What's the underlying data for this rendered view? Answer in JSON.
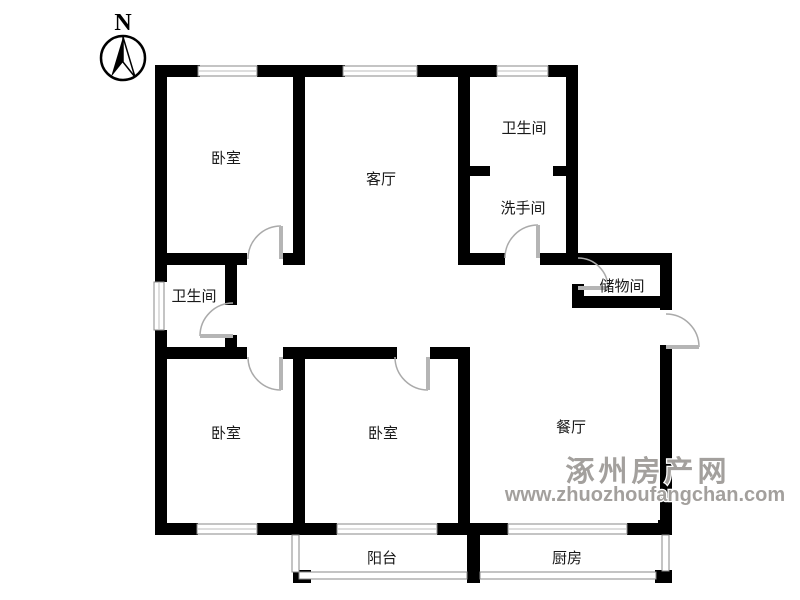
{
  "meta": {
    "background_color": "#ffffff",
    "wall_color": "#000000",
    "door_arc_color": "#aaaaaa",
    "window_frame_color": "#8a8a8a"
  },
  "compass": {
    "label": "N"
  },
  "rooms": [
    {
      "name": "bedroom-top-left",
      "label": "卧室"
    },
    {
      "name": "living-room",
      "label": "客厅"
    },
    {
      "name": "bathroom-top",
      "label": "卫生间"
    },
    {
      "name": "washroom",
      "label": "洗手间"
    },
    {
      "name": "storage-room",
      "label": "储物间"
    },
    {
      "name": "bathroom-left",
      "label": "卫生间"
    },
    {
      "name": "bedroom-bottom-left",
      "label": "卧室"
    },
    {
      "name": "bedroom-bottom-middle",
      "label": "卧室"
    },
    {
      "name": "dining-room",
      "label": "餐厅"
    },
    {
      "name": "balcony",
      "label": "阳台"
    },
    {
      "name": "kitchen",
      "label": "厨房"
    }
  ],
  "watermark": {
    "site_name": "涿州房产网",
    "url": "www.zhuozhoufangchan.com",
    "color": "#a3a09d"
  }
}
